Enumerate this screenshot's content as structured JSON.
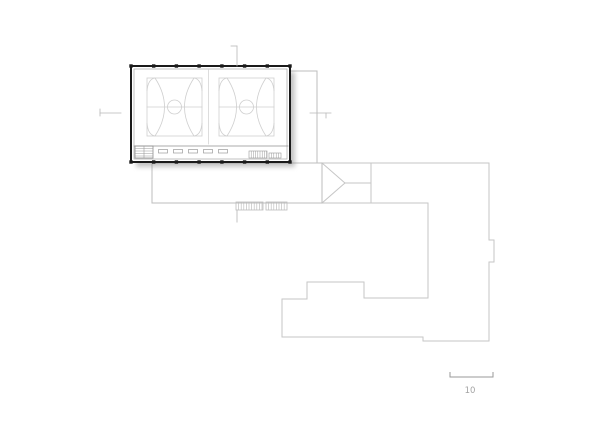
{
  "drawing": {
    "type": "architectural-site-plan",
    "canvas": {
      "width": 600,
      "height": 424
    },
    "colors": {
      "paper": "#ffffff",
      "wall": "#1a1a1a",
      "court_line": "#cfcfcf",
      "inner_line": "#a8a8a8",
      "interior_line": "#8f8f8f",
      "fixture_line": "#9a9a9a",
      "site_line": "#c6c6c6",
      "platform_line": "#bdbdbd",
      "marker_line": "#b8b8b8",
      "shadow": "#8a8a8a",
      "scale_line": "#9a9a9a",
      "scale_text": "#a3a3a3"
    },
    "shadow": {
      "x": 136,
      "y": 72,
      "w": 159,
      "h": 95,
      "opacity": 0.5,
      "blur": 2.5
    },
    "gym": {
      "outer": {
        "x": 131,
        "y": 66,
        "w": 159,
        "h": 96,
        "stroke_w": 2
      },
      "inner_inset": 3,
      "columns": {
        "size": 3.4,
        "top_y": 64.3,
        "bottom_y": 160.3,
        "xs": [
          131,
          153.7,
          176.4,
          199.1,
          221.9,
          244.6,
          267.3,
          290
        ]
      },
      "corridor_line": [
        134,
        146,
        288,
        146
      ],
      "divider_line": [
        208.5,
        70,
        208.5,
        144
      ],
      "benches": {
        "y": 149.5,
        "w": 9,
        "h": 3.5,
        "xs": [
          158.5,
          173.5,
          188.5,
          203.5,
          218.5
        ]
      },
      "stair_left": {
        "x": 135,
        "y": 146,
        "w": 18,
        "h": 12,
        "hlines_y": [
          148.5,
          151,
          153.5,
          156
        ],
        "divider_x": 144
      },
      "stair_right1": {
        "x": 249,
        "y": 151,
        "w": 18,
        "h": 7,
        "step": 2.2
      },
      "stair_right2": {
        "x": 269,
        "y": 153,
        "w": 12,
        "h": 5,
        "step": 2.4
      },
      "court": {
        "w": 55,
        "h": 58,
        "positions": [
          [
            147,
            78
          ],
          [
            219,
            78
          ]
        ],
        "center_line": [
          0,
          29,
          55,
          29
        ],
        "center_circle": {
          "cx": 27.5,
          "cy": 29,
          "r": 7
        },
        "paths": [
          "M8,0 Q27,29 8,58",
          "M47,0 Q28,29 47,58",
          "M8,0 Q1,1 0,13",
          "M47,0 Q54,1 55,13",
          "M8,58 Q1,57 0,45",
          "M47,58 Q54,57 55,45"
        ]
      }
    },
    "walkway": {
      "segments": [
        [
          290,
          71,
          317,
          71
        ],
        [
          317,
          71,
          317,
          163
        ]
      ]
    },
    "platform": {
      "segments": [
        [
          152,
          163,
          322,
          163
        ],
        [
          152,
          163,
          152,
          203
        ],
        [
          152,
          203,
          322,
          203
        ],
        [
          322,
          163,
          322,
          203
        ]
      ]
    },
    "exterior_stairs": {
      "boxes": [
        {
          "x": 236,
          "y": 202,
          "w": 27,
          "h": 8,
          "step": 2.6
        },
        {
          "x": 266,
          "y": 202,
          "w": 21,
          "h": 8,
          "step": 2.6
        }
      ],
      "tail_line": [
        237,
        210,
        237,
        222
      ]
    },
    "connector_roof": {
      "segments": [
        [
          322,
          163,
          345,
          183
        ],
        [
          322,
          203,
          345,
          183
        ],
        [
          345,
          183,
          371,
          183
        ],
        [
          371,
          163,
          371,
          203
        ]
      ]
    },
    "adjacent_building": {
      "segments": [
        [
          322,
          163,
          489,
          163
        ],
        [
          489,
          163,
          489,
          240
        ],
        [
          489,
          240,
          494,
          240
        ],
        [
          494,
          240,
          494,
          262
        ],
        [
          494,
          262,
          489,
          262
        ],
        [
          489,
          262,
          489,
          341
        ],
        [
          489,
          341,
          423,
          341
        ],
        [
          423,
          341,
          423,
          337
        ],
        [
          423,
          337,
          282,
          337
        ],
        [
          282,
          337,
          282,
          299
        ],
        [
          282,
          299,
          307,
          299
        ],
        [
          307,
          299,
          307,
          282
        ],
        [
          307,
          282,
          364,
          282
        ],
        [
          364,
          282,
          364,
          298
        ],
        [
          364,
          298,
          428,
          298
        ],
        [
          428,
          298,
          428,
          203
        ],
        [
          428,
          203,
          322,
          203
        ]
      ]
    },
    "section_markers": {
      "top": {
        "line": [
          237,
          46,
          237,
          66
        ],
        "tick": [
          231,
          46,
          237,
          46
        ]
      },
      "left": {
        "line": [
          100,
          113,
          121,
          113
        ],
        "tick": [
          100,
          109,
          100,
          116
        ]
      },
      "right": {
        "line": [
          310,
          113,
          331,
          113
        ],
        "tick": [
          326,
          113,
          326,
          118
        ]
      }
    },
    "scale_bar": {
      "x1": 450,
      "x2": 493,
      "y": 377,
      "tick_h": 5,
      "label": "10",
      "label_x": 470,
      "label_y": 393
    }
  }
}
